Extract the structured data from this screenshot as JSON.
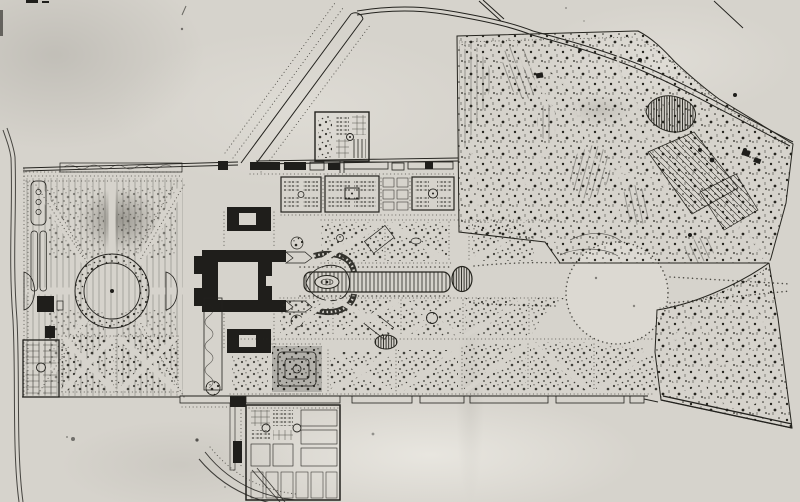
{
  "plan": {
    "title": "Scanned monochrome estate plan: a château with formal parterre gardens, long basin and circular rond-point on an east-west axis, tree-lined approach avenue at the north-west, walled kitchen gardens, and a winding English landscape park occupying the north-east",
    "media": "ink on aged paper, black-and-white photographic scan",
    "text_labels": "none legible in the image"
  },
  "colors": {
    "paper": "#d6d3cc",
    "paper_bright": "#efede7",
    "ink": "#1f1e1b",
    "ink_soft": "#45443f",
    "stain": "#55534c"
  },
  "features": {
    "paper": "aged paper background with stains and specks",
    "roads": "perimeter and approach roads",
    "avenue": "tree-lined approach avenue with circular terminus",
    "north_boundary": "north boundary wall with row of service buildings",
    "north_square": "detached walled garden square north of the boundary",
    "left_garden": "western parterre garden with circular basin and radiating allées",
    "sw_potager": "small walled kitchen garden, south-west corner",
    "chateau": "château with courtyards, outbuildings and horseshoe ramp",
    "kitchen_squares": "walled kitchen-garden squares with central basins",
    "bosquets": "bosquet compartments with diagonal walks and tree stippling",
    "maze": "dense labyrinth-like bosquet",
    "axis": "main east-west axis",
    "long_basin": "long rectangular basin with oval island",
    "oval_basin": "dark oval pool on the axis",
    "rond_point": "great circular clearing ringed with trees",
    "english_garden": "English landscape park with winding walks, ponds, meadows and groves",
    "pond": "irregular pond",
    "lawn": "diagonally hatched great lawn",
    "south_wall": "southern terrace wall with stairs",
    "potager": "walled kitchen garden south of the terrace",
    "curved_road": "curved service road at the south entrance"
  }
}
